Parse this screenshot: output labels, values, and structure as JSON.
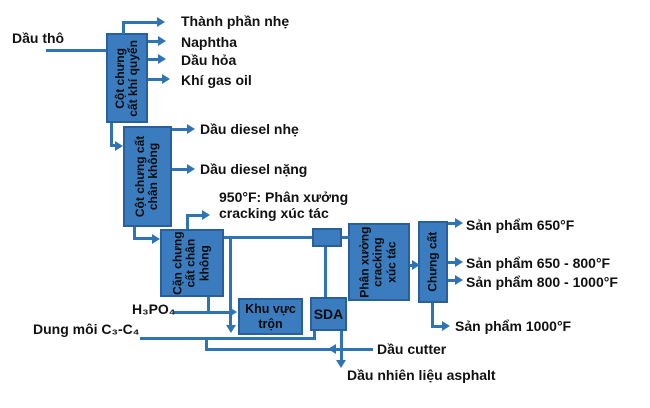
{
  "colors": {
    "box_fill": "#3b7cbf",
    "box_border": "#2a5f9e",
    "line": "#2e74b5",
    "label_text": "#111111"
  },
  "boxes": {
    "atmospheric_column": {
      "lines": [
        "Cột chưng",
        "cất khí quyển"
      ]
    },
    "vacuum_column": {
      "lines": [
        "Cột chưng cất",
        "chân không"
      ]
    },
    "vacuum_residue": {
      "lines": [
        "Cặn chưng",
        "cất chân",
        "không"
      ]
    },
    "cat_cracking_unit": {
      "lines": [
        "Phân xưởng",
        "cracking",
        "xúc tác"
      ]
    },
    "distillation": {
      "lines": [
        "Chưng cất"
      ]
    },
    "mixing_area": {
      "lines": [
        "Khu vực",
        "trộn"
      ]
    },
    "sda_unit": {
      "lines": [
        "SDA"
      ]
    }
  },
  "stream_labels": {
    "crude_oil": "Dầu thô",
    "light_components": "Thành phần nhẹ",
    "naphtha": "Naphtha",
    "kerosene": "Dầu hỏa",
    "gas_oil": "Khí gas oil",
    "light_diesel": "Dầu diesel nhẹ",
    "heavy_diesel": "Dầu diesel nặng",
    "cracking_note_line1": "950°F: Phân xưởng",
    "cracking_note_line2": "cracking xúc tác",
    "h3po4": "H₃PO₄",
    "solvent": "Dung môi C₃-C₄",
    "product_650": "Sản phẩm 650°F",
    "product_650_800": "Sản phẩm 650 - 800°F",
    "product_800_1000": "Sản phẩm 800 - 1000°F",
    "product_1000": "Sản phẩm 1000°F",
    "cutter_oil": "Dầu cutter",
    "asphalt_fuel_oil": "Dầu nhiên liệu asphalt"
  }
}
